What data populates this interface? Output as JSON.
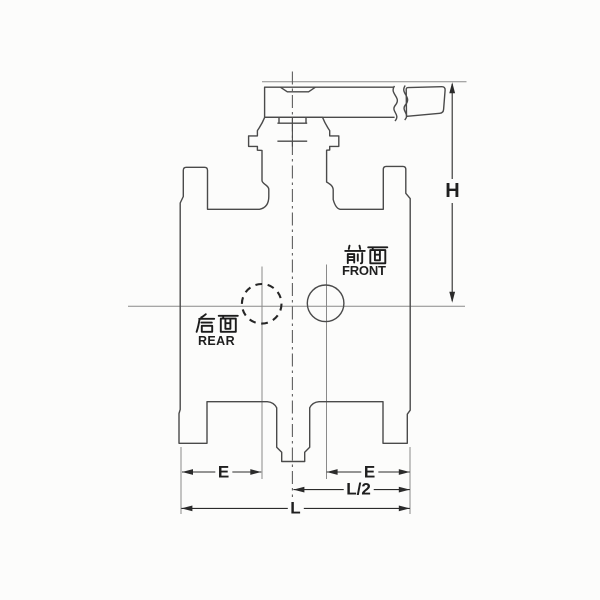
{
  "drawing": {
    "kind": "valve-engineering-drawing",
    "views": {
      "front": {
        "cjk": "前面",
        "latin": "FRONT"
      },
      "rear": {
        "cjk": "后面",
        "latin": "REAR"
      }
    },
    "dimensions": {
      "h": {
        "label": "H"
      },
      "e_left": {
        "label": "E"
      },
      "e_right": {
        "label": "E"
      },
      "l_half": {
        "label": "L/2"
      },
      "l": {
        "label": "L"
      }
    },
    "colors": {
      "background": "#fcfcfb",
      "outline": "#4a4a4a",
      "thin_line": "#8a8a8a",
      "centerline": "#5f5f5f",
      "dashed_port": "#262626",
      "dimension": "#2b2b2b",
      "text": "#1f1f1f"
    }
  }
}
